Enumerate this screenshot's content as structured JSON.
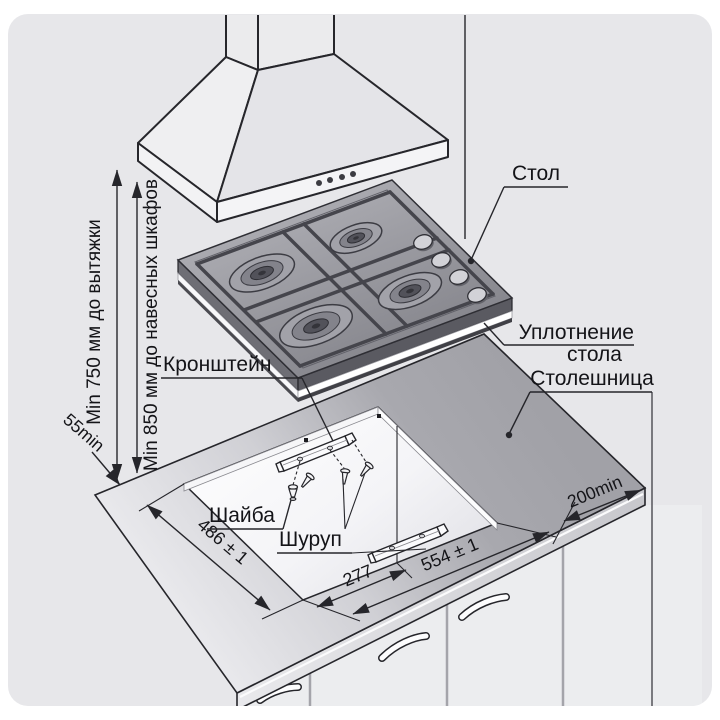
{
  "page": {
    "background": "#ffffff",
    "panel_background": "#e7e7ea",
    "line_color": "#26262b",
    "countertop_color": "#a6a6ac",
    "cooktop_color": "#8a8a91"
  },
  "labels": {
    "table": "Стол",
    "table_seal_line1": "Уплотнение",
    "table_seal_line2": "стола",
    "countertop": "Столешница",
    "bracket": "Кронштейн",
    "washer": "Шайба",
    "screw": "Шуруп"
  },
  "dimensions": {
    "min_to_hood": "Min 750 мм до вытяжки",
    "min_to_cabinets": "Min 850 мм до навесных шкафов",
    "rear_min": "55min",
    "right_min": "200min",
    "cutout_depth": "486 ± 1",
    "cutout_width": "554 ± 1",
    "cutout_half_width": "277"
  }
}
